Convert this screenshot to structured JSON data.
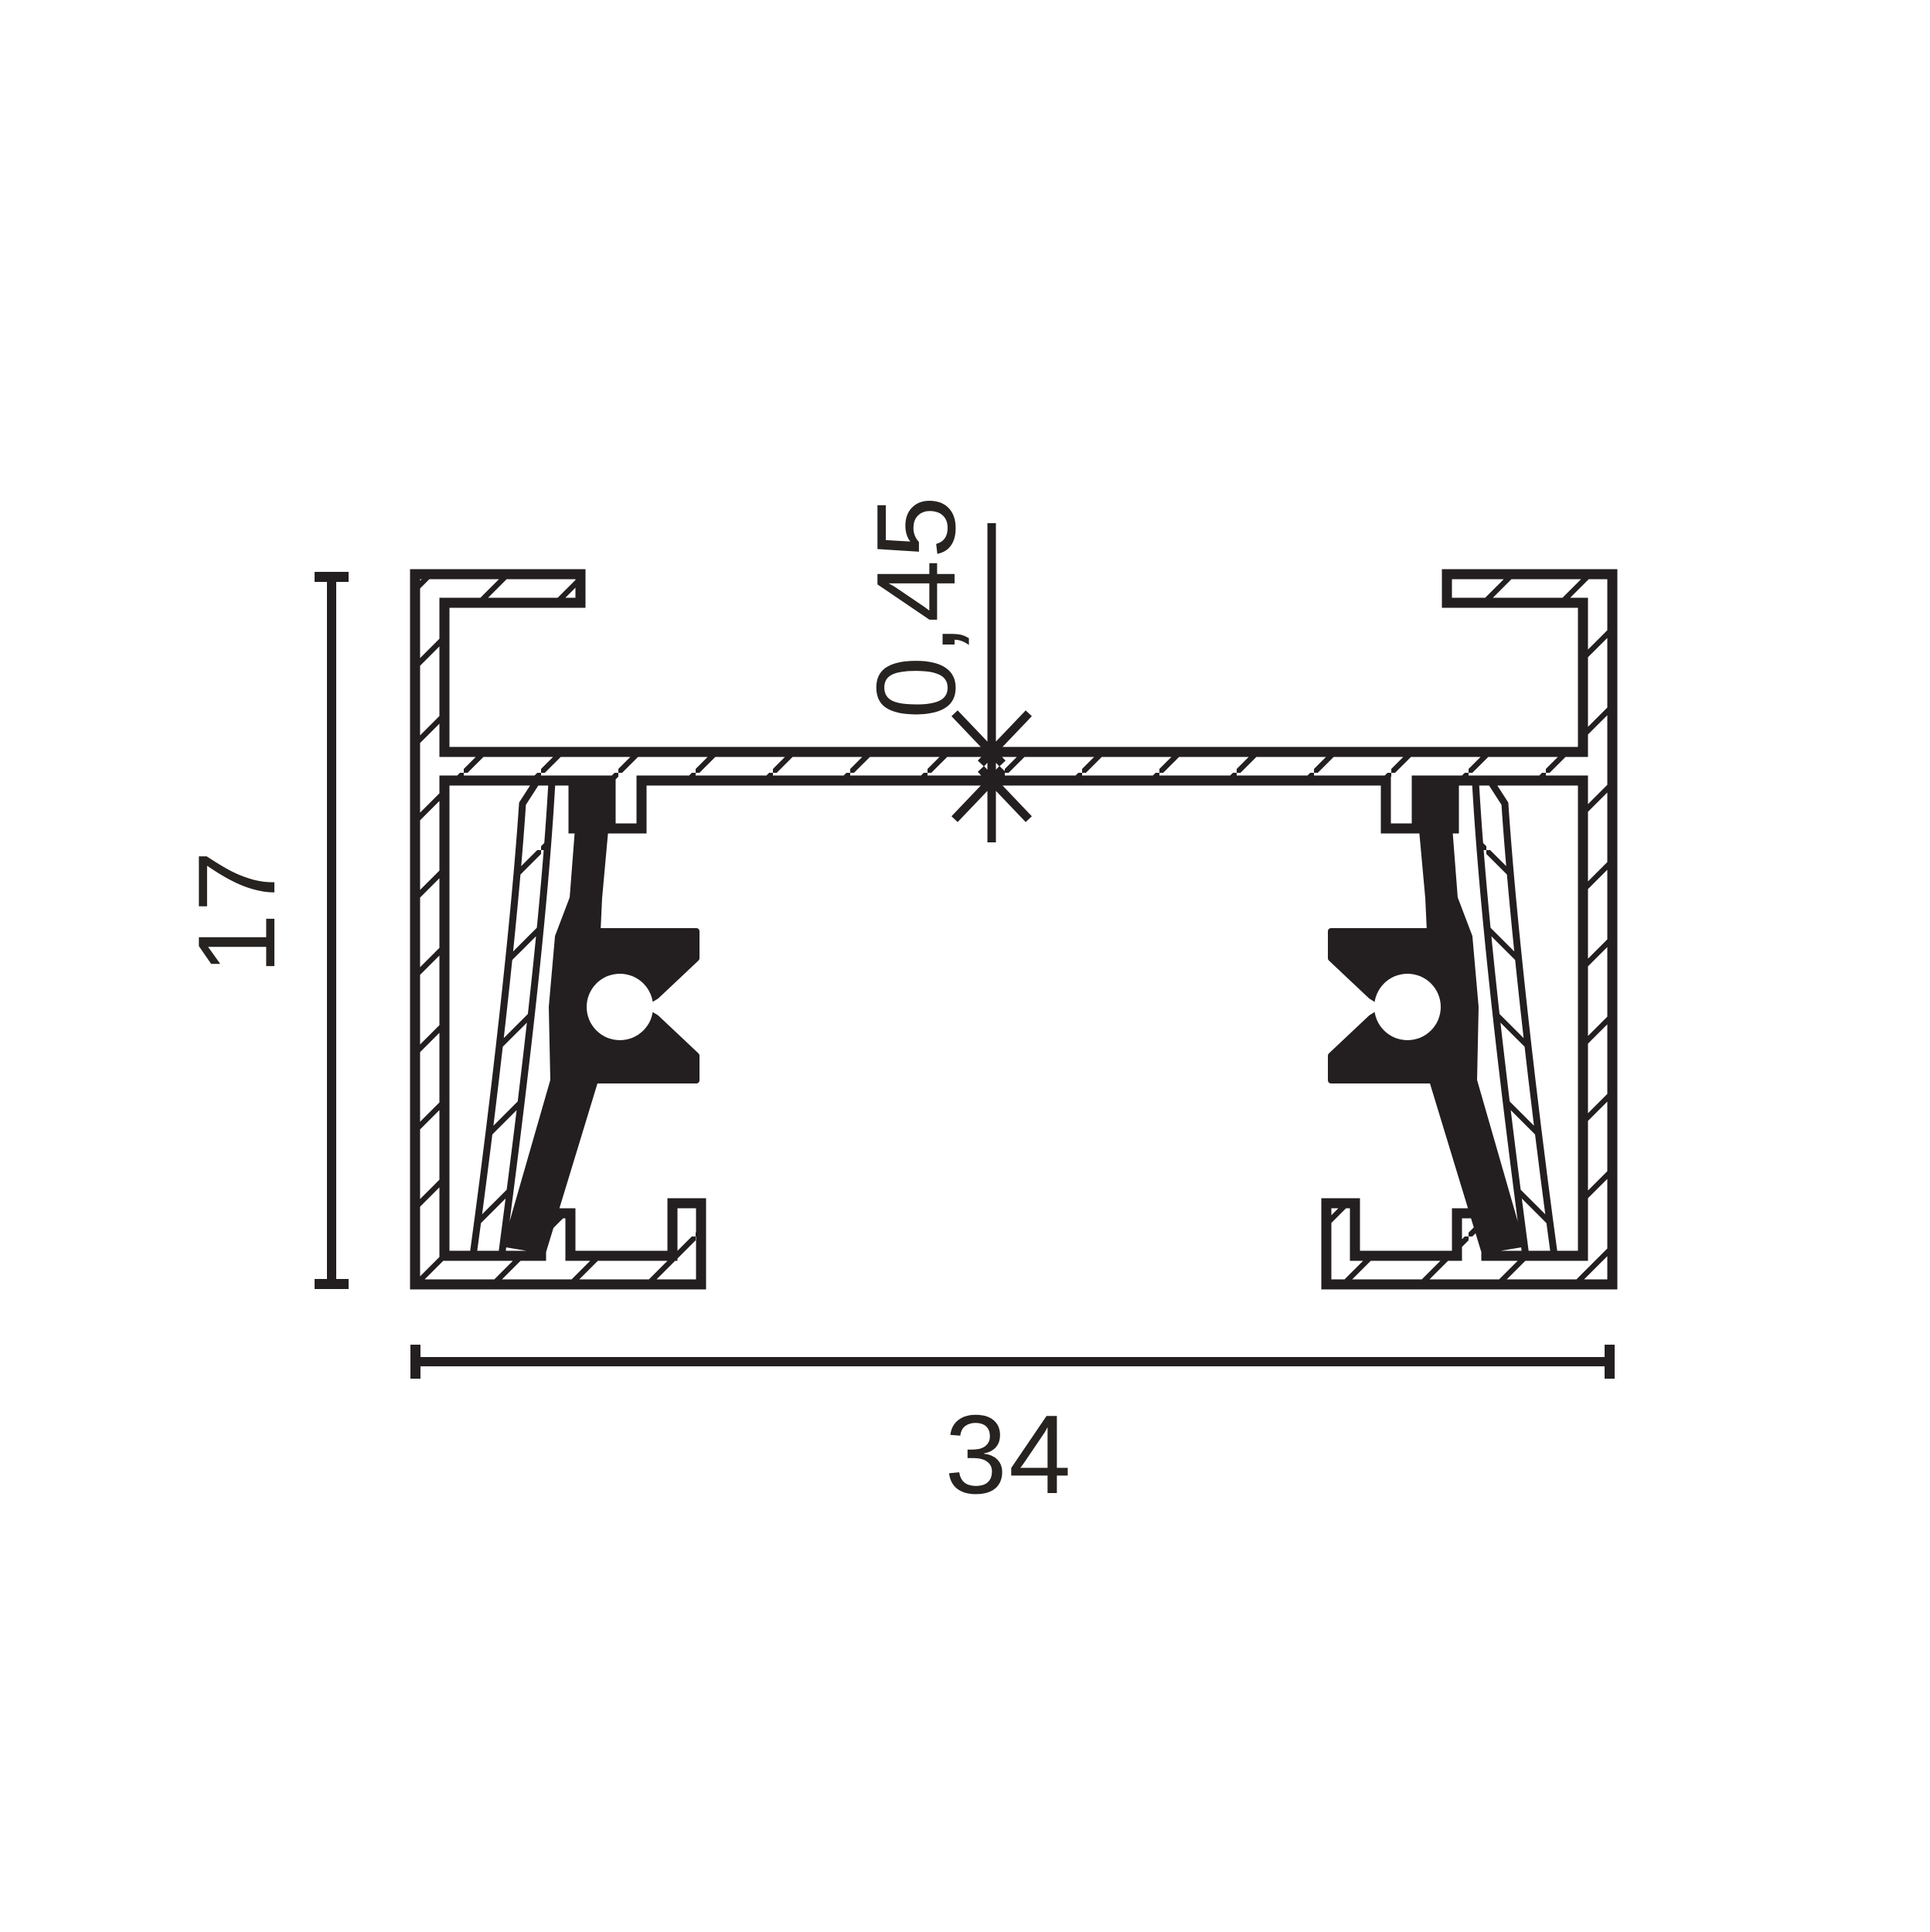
{
  "drawing": {
    "kind": "profile-cross-section-dimension-drawing",
    "background_color": "#ffffff",
    "line_color": "#231f20",
    "solid_fill_color": "#231f20",
    "labels": {
      "height": "17",
      "width": "34",
      "web_thickness": "0,45"
    }
  }
}
